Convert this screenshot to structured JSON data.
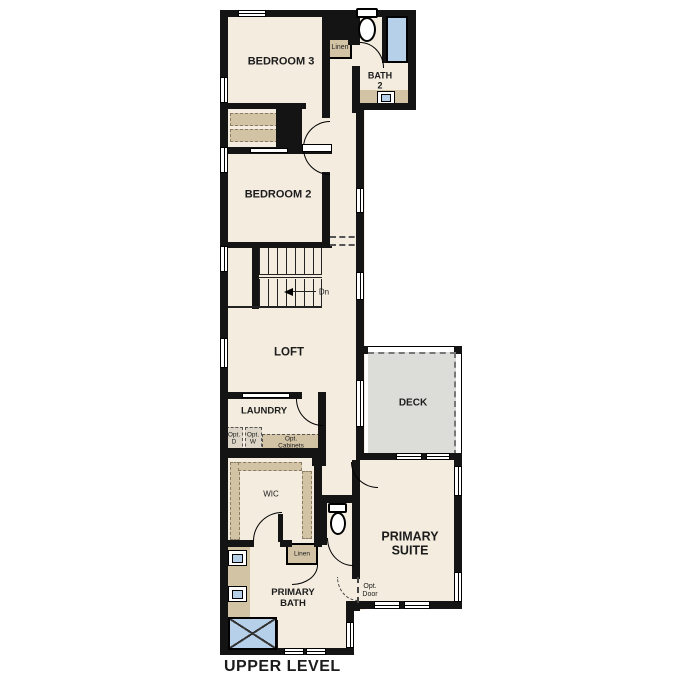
{
  "plan_title": "UPPER LEVEL",
  "rooms": {
    "bedroom3": "BEDROOM 3",
    "bath2_l1": "BATH",
    "bath2_l2": "2",
    "bedroom2": "BEDROOM 2",
    "loft": "LOFT",
    "laundry": "LAUNDRY",
    "deck": "DECK",
    "wic": "WIC",
    "primary_suite_l1": "PRIMARY",
    "primary_suite_l2": "SUITE",
    "primary_bath_l1": "PRIMARY",
    "primary_bath_l2": "BATH"
  },
  "annotations": {
    "linen_top": "Linen",
    "linen_bottom": "Linen",
    "stairs_down": "Dn",
    "opt_dryer_l1": "Opt.",
    "opt_dryer_l2": "D",
    "opt_washer_l1": "Opt.",
    "opt_washer_l2": "W",
    "opt_cabinets_l1": "Opt.",
    "opt_cabinets_l2": "Cabinets",
    "opt_door_l1": "Opt.",
    "opt_door_l2": "Door"
  },
  "colors": {
    "floor": "#f3ecdf",
    "wall": "#141414",
    "tan": "#d2c3a5",
    "blue": "#b7d0ea",
    "deck": "#dcdcd8",
    "text": "#1c1c1c"
  }
}
